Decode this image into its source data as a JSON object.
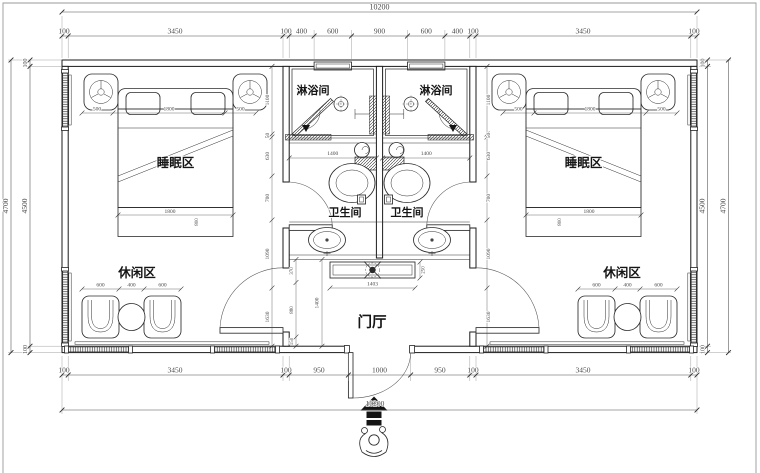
{
  "plan": {
    "room_labels": {
      "sleep": "睡眠区",
      "leisure": "休闲区",
      "shower": "淋浴间",
      "toilet": "卫生间",
      "hall": "门厅"
    },
    "dimensions": {
      "overall_width": "10200",
      "overall_width_bottom": "10200",
      "top_row": [
        "100",
        "3450",
        "100",
        "400",
        "600",
        "900",
        "600",
        "400",
        "100",
        "3450",
        "100"
      ],
      "bottom_row": [
        "100",
        "3450",
        "100",
        "950",
        "1000",
        "950",
        "100",
        "3450",
        "100"
      ],
      "side": {
        "wall": "100",
        "inner": "4500",
        "outer": "4700"
      },
      "bed_row": [
        "500",
        "1800",
        "500"
      ],
      "bed_length": "1800",
      "bed_width": "800",
      "leisure_row": [
        "600",
        "400",
        "600"
      ],
      "shower_width": "1400",
      "console_width": "1403",
      "console_depth": "250",
      "hall_depth": "1400",
      "hall_chain": [
        "370",
        "880",
        "150"
      ],
      "interior_chain": [
        "1100",
        "50",
        "630",
        "700",
        "1090",
        "1630"
      ]
    }
  }
}
